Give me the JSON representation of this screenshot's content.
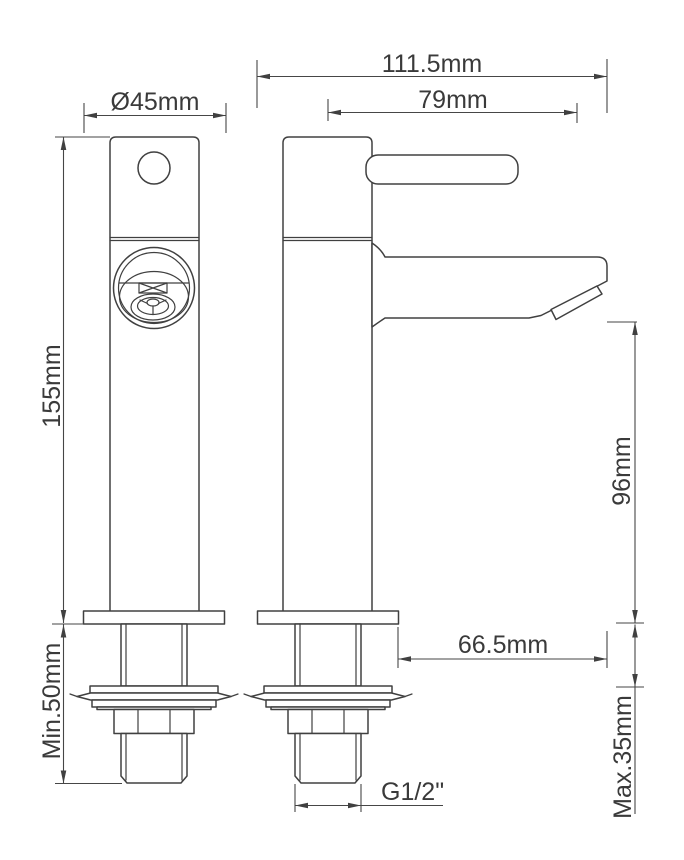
{
  "drawing": {
    "colors": {
      "background": "#ffffff",
      "line": "#404040",
      "text": "#3a3a3a"
    },
    "dimensions": {
      "base_diameter": "Ø45mm",
      "overall_depth": "111.5mm",
      "spout_reach": "79mm",
      "body_height": "155mm",
      "spout_height": "96mm",
      "spout_projection": "66.5mm",
      "min_mounting_depth": "Min.50mm",
      "max_deck_thickness": "Max.35mm",
      "thread_size": "G1/2\""
    }
  }
}
